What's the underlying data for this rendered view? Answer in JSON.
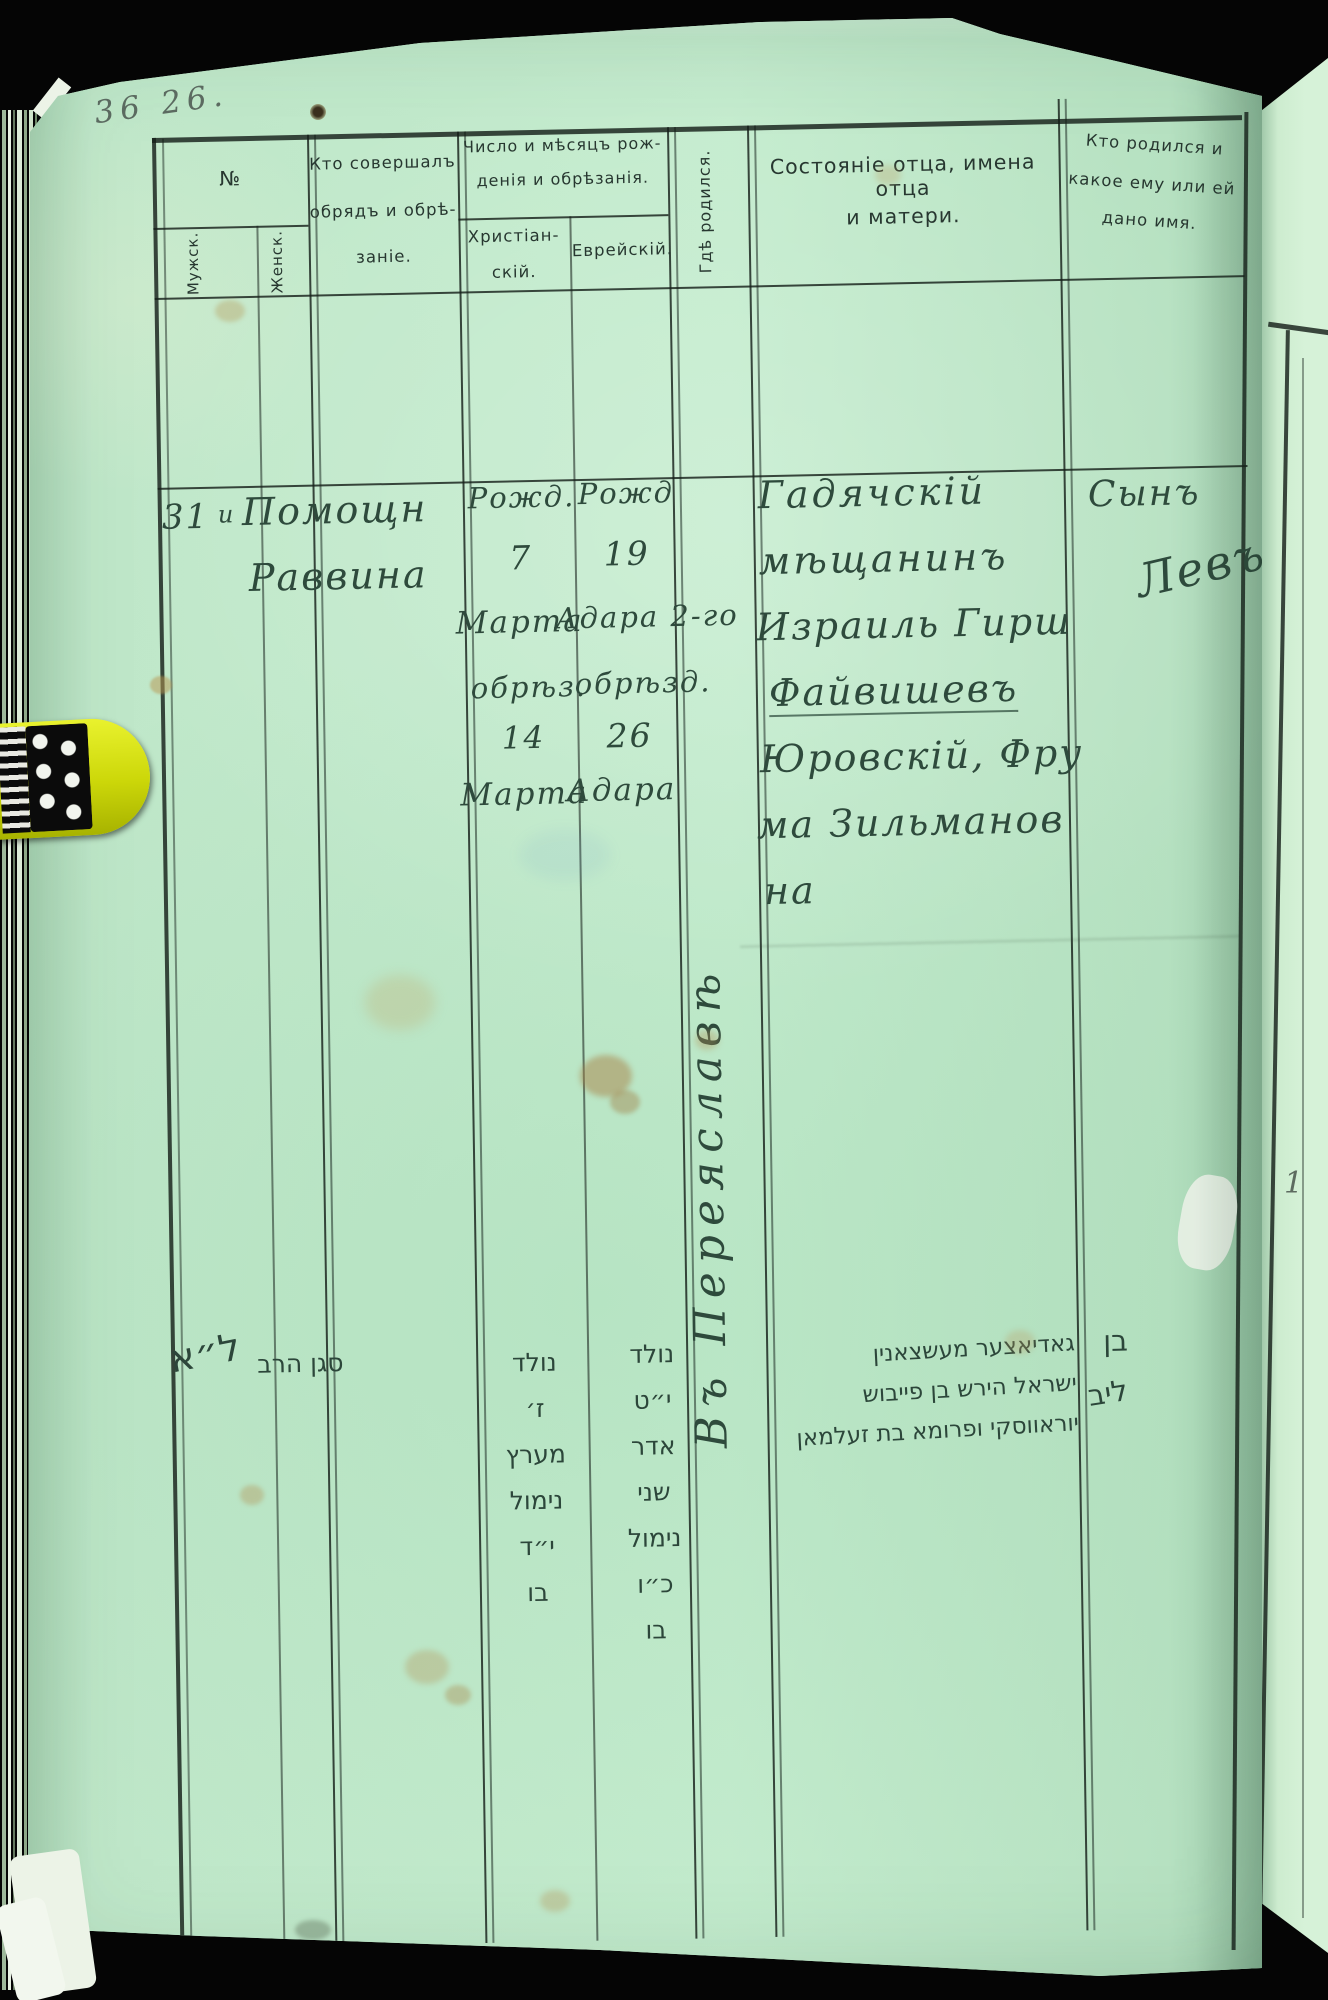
{
  "document": {
    "corner_note": "36 26.",
    "neighbor_page_mark": "1"
  },
  "header": {
    "col_no": "№",
    "col_male": "Мужск.",
    "col_female": "Женск.",
    "col_officiant": [
      "Кто совершалъ",
      "обрядъ и обрѣ-",
      "заніе."
    ],
    "col_dates": [
      "Число и мѣсяцъ рож-",
      "денія и обрѣзанія."
    ],
    "col_date_christian": [
      "Христіан-",
      "скій."
    ],
    "col_date_jewish": "Еврейскій.",
    "col_where_born": "Гдѣ родился.",
    "col_father": [
      "Состояніе отца, имена отца",
      "и матери."
    ],
    "col_child": [
      "Кто родился и",
      "какое ему или ей",
      "дано имя."
    ]
  },
  "entry": {
    "row_number": "31",
    "row_mark": "и",
    "officiant": [
      "Помощн",
      "Раввина"
    ],
    "date_christian": [
      "Рожд.",
      "7",
      "Марта",
      "обрѣз.",
      "14",
      "Марта"
    ],
    "date_jewish": [
      "Рожд",
      "19",
      "Адара 2-го",
      "обрѣзд.",
      "26",
      "Адара"
    ],
    "where_born": "Въ Переяславѣ",
    "father": [
      "Гадячскій",
      "мѣщанинъ",
      "Израиль Гирш",
      "Файвишевъ",
      "Юровскій, Фру",
      "ма Зильманов",
      "на"
    ],
    "child": [
      "Сынъ",
      "Левъ"
    ]
  },
  "hebrew": {
    "margin_number": "ל״א",
    "officiant": "סגן הרב",
    "dates_christian": [
      "נולד",
      "ז׳",
      "מערץ",
      "נימול",
      "י״ד",
      "בו"
    ],
    "dates_jewish": [
      "נולד",
      "י״ט",
      "אדר",
      "שני",
      "נימול",
      "כ״ו",
      "בו"
    ],
    "father": [
      "גאדיאצער מעשצאנין",
      "ישראל הירש בן פייבוש",
      "יוראווסקי ופרומא בת זעלמאן"
    ],
    "child": [
      "בן",
      "ליב"
    ]
  }
}
